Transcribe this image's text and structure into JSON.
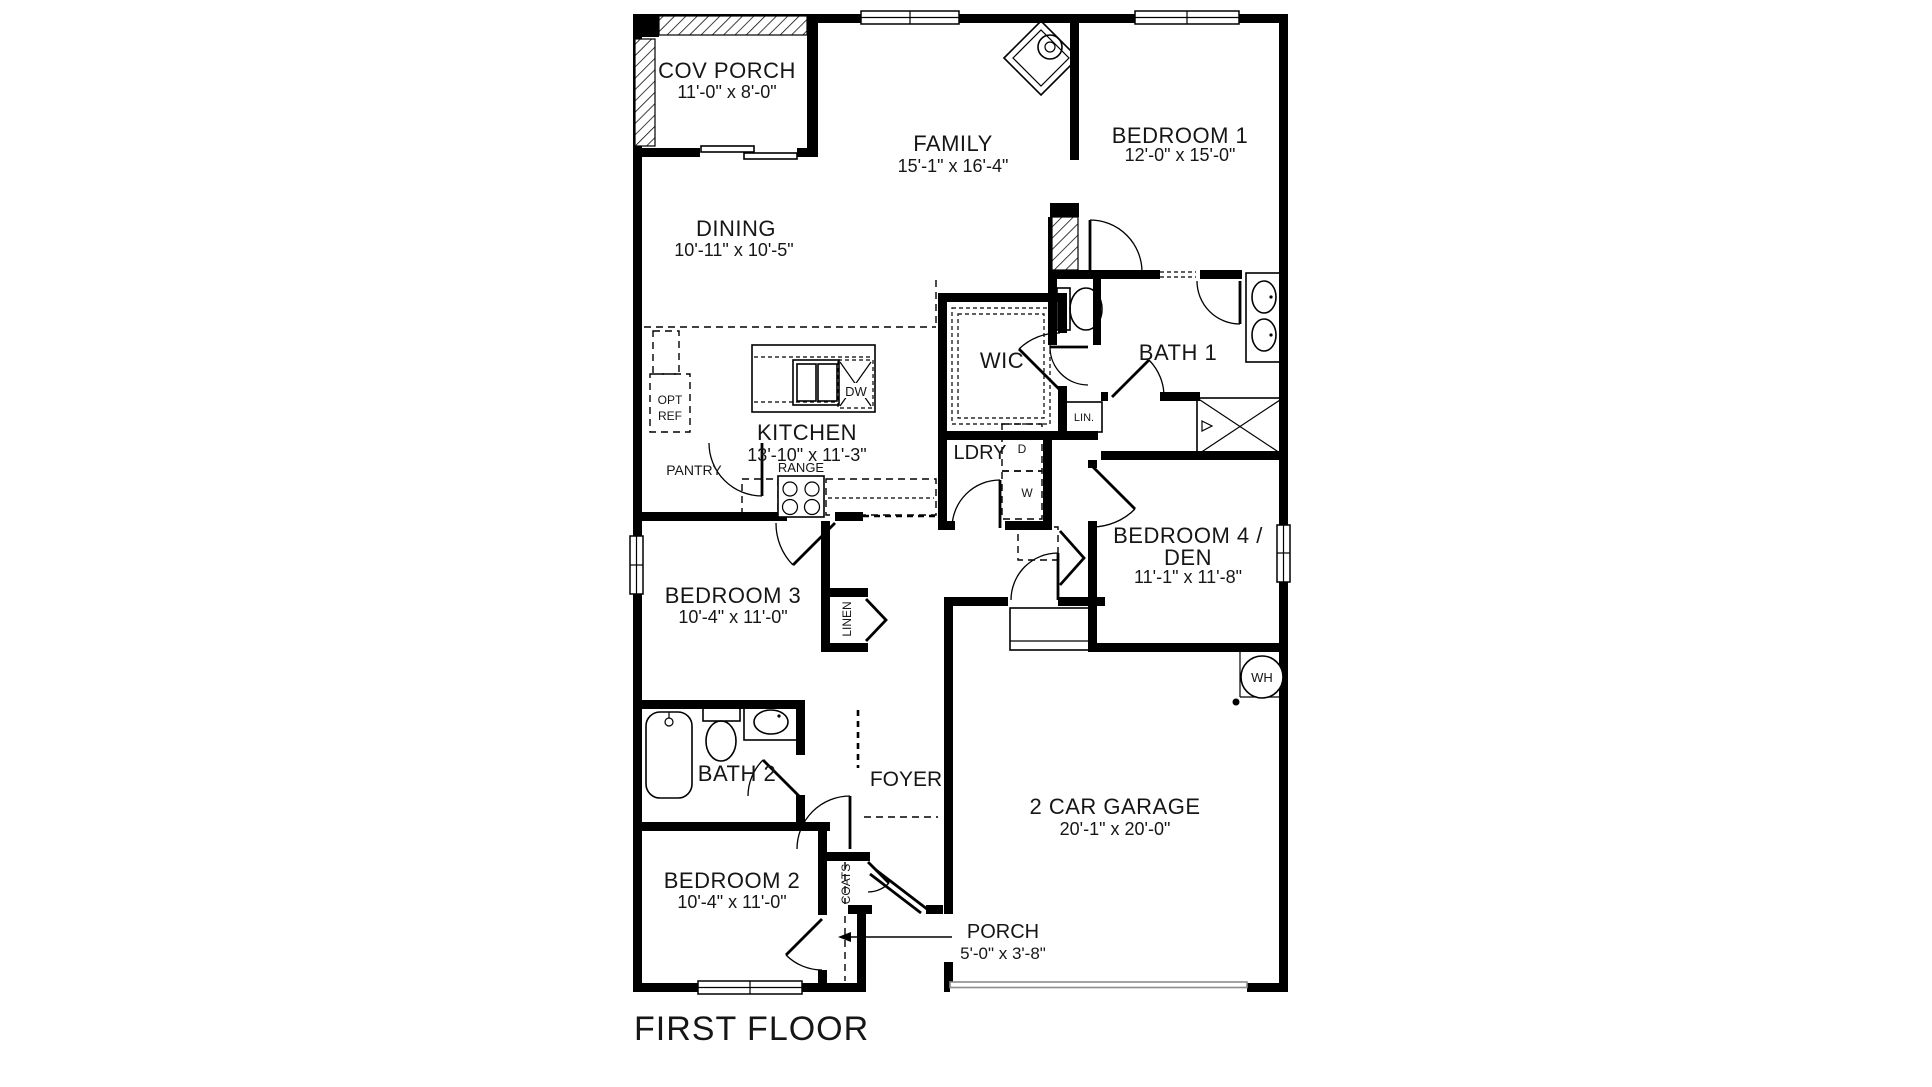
{
  "title": {
    "text": "FIRST FLOOR"
  },
  "rooms": {
    "cov_porch": {
      "name": "COV PORCH",
      "dims": "11'-0\" x 8'-0\""
    },
    "family": {
      "name": "FAMILY",
      "dims": "15'-1\" x 16'-4\""
    },
    "bedroom1": {
      "name": "BEDROOM 1",
      "dims": "12'-0\" x 15'-0\""
    },
    "dining": {
      "name": "DINING",
      "dims": "10'-11\" x 10'-5\""
    },
    "kitchen": {
      "name": "KITCHEN",
      "dims": "13'-10\" x 11'-3\""
    },
    "wic": {
      "name": "WIC"
    },
    "bath1": {
      "name": "BATH 1"
    },
    "ldry": {
      "name": "LDRY"
    },
    "bedroom4": {
      "name_line1": "BEDROOM 4 /",
      "name_line2": "DEN",
      "dims": "11'-1\" x 11'-8\""
    },
    "bedroom3": {
      "name": "BEDROOM 3",
      "dims": "10'-4\" x 11'-0\""
    },
    "bath2": {
      "name": "BATH 2"
    },
    "foyer": {
      "name": "FOYER"
    },
    "bedroom2": {
      "name": "BEDROOM 2",
      "dims": "10'-4\" x 11'-0\""
    },
    "garage": {
      "name": "2 CAR GARAGE",
      "dims": "20'-1\" x 20'-0\""
    },
    "porch": {
      "name": "PORCH",
      "dims": "5'-0\" x 3'-8\""
    }
  },
  "labels": {
    "opt_line1": "OPT",
    "opt_line2": "REF",
    "pantry": "PANTRY",
    "range": "RANGE",
    "dw": "DW",
    "lin": "LIN.",
    "dryer": "D",
    "washer": "W",
    "linen": "LINEN",
    "coats": "COATS",
    "wh": "WH"
  },
  "colors": {
    "wall": "#000000",
    "text": "#161616",
    "thin_line": "#8c8c8c",
    "background": "#ffffff"
  }
}
